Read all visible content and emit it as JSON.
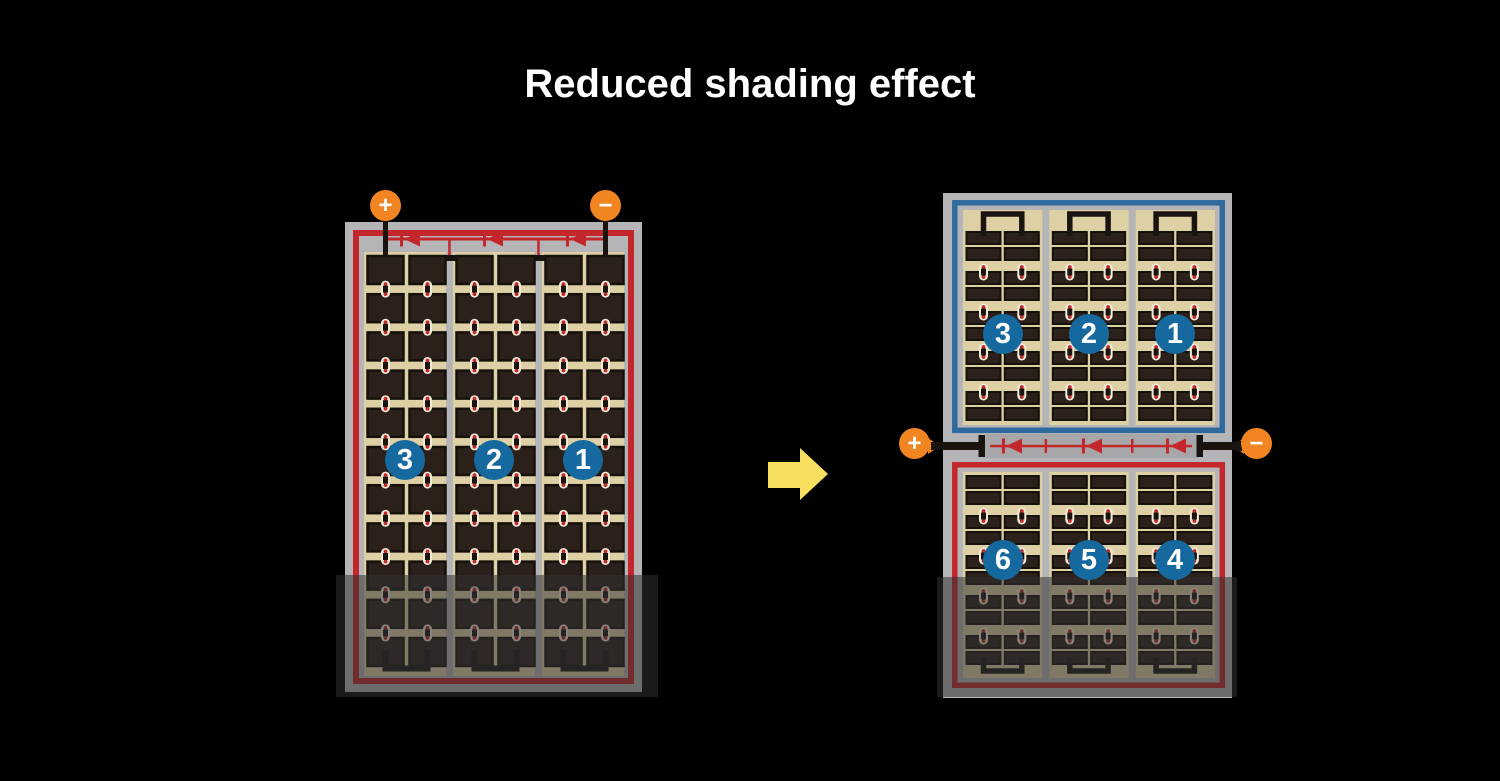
{
  "title": "Reduced shading effect",
  "colors": {
    "background": "#000000",
    "title_text": "#ffffff",
    "frame_gray": "#b5b5b7",
    "junction_gray": "#a7a7a9",
    "panel_tan": "#ddd0a4",
    "cell_dark": "#2b211a",
    "cell_edge": "#17110c",
    "wire_black": "#1a1410",
    "circuit_red": "#c4272b",
    "string_blue": "#2f6a9e",
    "badge_blue": "#16699f",
    "terminal_orange": "#f08522",
    "arrow_yellow": "#f8df5f",
    "connector_light": "#f3ead6",
    "shade": "rgba(50,50,50,0.55)"
  },
  "left_panel": {
    "section_labels": [
      "3",
      "2",
      "1"
    ],
    "terminal_plus": "+",
    "terminal_minus": "−"
  },
  "right_panel": {
    "top_section_labels": [
      "3",
      "2",
      "1"
    ],
    "bottom_section_labels": [
      "6",
      "5",
      "4"
    ],
    "terminal_plus": "+",
    "terminal_minus": "−"
  }
}
